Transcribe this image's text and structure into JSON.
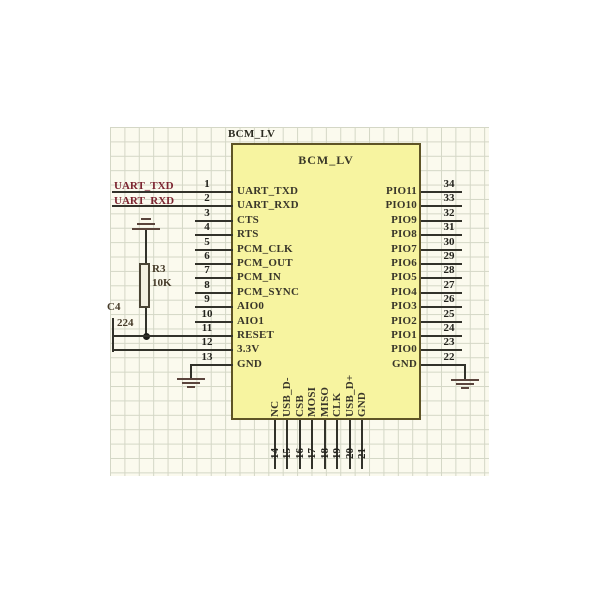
{
  "chip": {
    "designator": "BCM_LV",
    "title": "BCM_LV",
    "left_pins": [
      {
        "num": "1",
        "label": "UART_TXD"
      },
      {
        "num": "2",
        "label": "UART_RXD"
      },
      {
        "num": "3",
        "label": "CTS"
      },
      {
        "num": "4",
        "label": "RTS"
      },
      {
        "num": "5",
        "label": "PCM_CLK"
      },
      {
        "num": "6",
        "label": "PCM_OUT"
      },
      {
        "num": "7",
        "label": "PCM_IN"
      },
      {
        "num": "8",
        "label": "PCM_SYNC"
      },
      {
        "num": "9",
        "label": "AIO0"
      },
      {
        "num": "10",
        "label": "AIO1"
      },
      {
        "num": "11",
        "label": "RESET"
      },
      {
        "num": "12",
        "label": "3.3V"
      },
      {
        "num": "13",
        "label": "GND"
      }
    ],
    "right_pins": [
      {
        "num": "34",
        "label": "PIO11"
      },
      {
        "num": "33",
        "label": "PIO10"
      },
      {
        "num": "32",
        "label": "PIO9"
      },
      {
        "num": "31",
        "label": "PIO8"
      },
      {
        "num": "30",
        "label": "PIO7"
      },
      {
        "num": "29",
        "label": "PIO6"
      },
      {
        "num": "28",
        "label": "PIO5"
      },
      {
        "num": "27",
        "label": "PIO4"
      },
      {
        "num": "26",
        "label": "PIO3"
      },
      {
        "num": "25",
        "label": "PIO2"
      },
      {
        "num": "24",
        "label": "PIO1"
      },
      {
        "num": "23",
        "label": "PIO0"
      },
      {
        "num": "22",
        "label": "GND"
      }
    ],
    "bottom_pins": [
      {
        "num": "14",
        "label": "NC"
      },
      {
        "num": "15",
        "label": "USB_D-"
      },
      {
        "num": "16",
        "label": "CSB"
      },
      {
        "num": "17",
        "label": "MOSI"
      },
      {
        "num": "18",
        "label": "MISO"
      },
      {
        "num": "19",
        "label": "CLK"
      },
      {
        "num": "20",
        "label": "USB_D+"
      },
      {
        "num": "21",
        "label": "GND"
      }
    ]
  },
  "components": {
    "r3": {
      "ref": "R3",
      "value": "10K"
    },
    "c4": {
      "ref": "C4",
      "value": "224"
    }
  },
  "net_labels": {
    "uart_txd": "UART_TXD",
    "uart_rxd": "UART_RXD"
  },
  "colors": {
    "chip_fill": "#f7f4a0",
    "chip_border": "#5e5426",
    "wire": "#32322a",
    "net_label": "#7c2430",
    "grid_bg": "#fbfaee",
    "grid_line": "#d4d7c6",
    "ground": "#5a443c"
  }
}
